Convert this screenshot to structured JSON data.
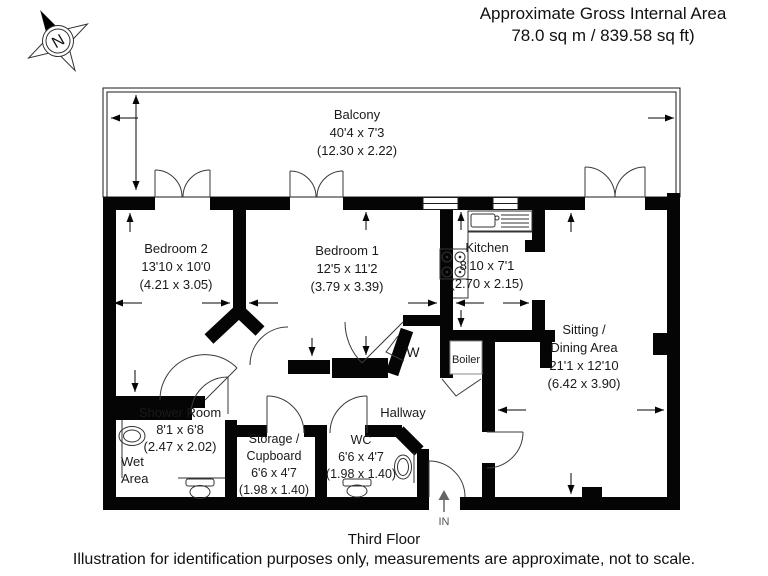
{
  "header": {
    "line1": "Approximate Gross Internal Area",
    "line2": "78.0 sq m / 839.58 sq ft)"
  },
  "compass": {
    "label": "N"
  },
  "rooms": {
    "balcony": {
      "name": "Balcony",
      "imperial": "40'4 x 7'3",
      "metric": "(12.30 x 2.22)"
    },
    "bedroom2": {
      "name": "Bedroom 2",
      "imperial": "13'10 x 10'0",
      "metric": "(4.21 x 3.05)"
    },
    "bedroom1": {
      "name": "Bedroom 1",
      "imperial": "12'5 x 11'2",
      "metric": "(3.79 x 3.39)"
    },
    "kitchen": {
      "name": "Kitchen",
      "imperial": "8'10 x 7'1",
      "metric": "(2.70 x 2.15)"
    },
    "sitting": {
      "name_line1": "Sitting /",
      "name_line2": "Dining Area",
      "imperial": "21'1 x 12'10",
      "metric": "(6.42 x 3.90)"
    },
    "shower": {
      "name": "Shower Room",
      "imperial": "8'1 x 6'8",
      "metric": "(2.47 x 2.02)",
      "wet_line1": "Wet",
      "wet_line2": "Area"
    },
    "storage": {
      "name_line1": "Storage /",
      "name_line2": "Cupboard",
      "imperial": "6'6 x 4'7",
      "metric": "(1.98 x 1.40)"
    },
    "wc": {
      "name": "WC",
      "imperial": "6'6 x 4'7",
      "metric": "(1.98 x 1.40)"
    },
    "hallway": {
      "name": "Hallway"
    },
    "wardrobe": {
      "label": "W"
    },
    "boiler": {
      "label": "Boiler"
    },
    "entrance": {
      "label": "IN"
    }
  },
  "footer": {
    "floor": "Third Floor",
    "disclaimer": "Illustration for identification purposes only, measurements are approximate, not to scale."
  }
}
